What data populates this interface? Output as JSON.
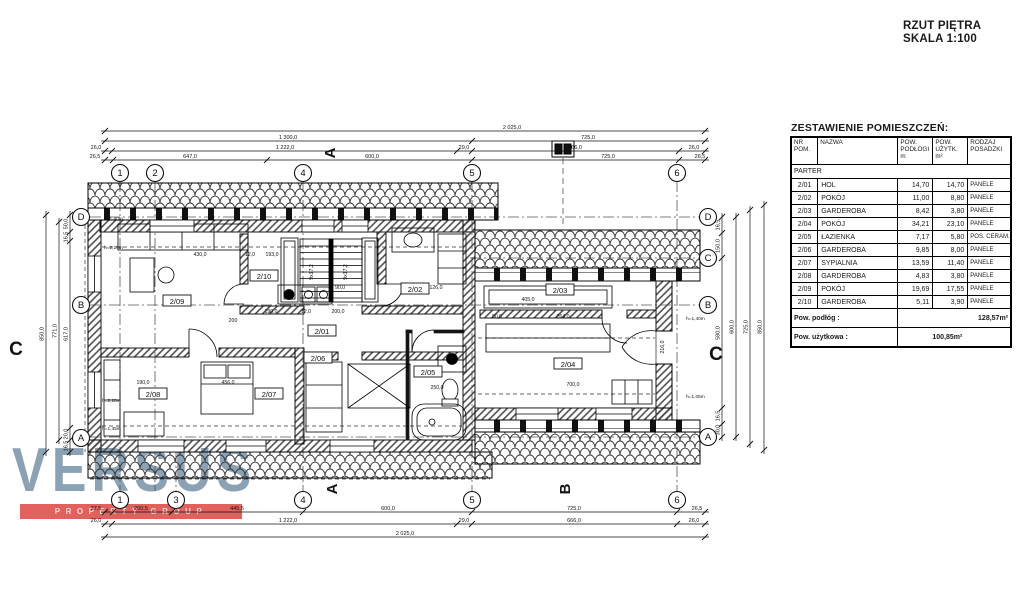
{
  "title": {
    "line1": "RZUT PIĘTRA",
    "line2": "SKALA 1:100"
  },
  "logo": {
    "name": "VERSUS",
    "tagline": "PROPERTY GROUP"
  },
  "colors": {
    "logo_letters": "#8aa2b4",
    "logo_bar": "#e2615d",
    "ink": "#1a1a1a"
  },
  "room_table": {
    "heading": "ZESTAWIENIE POMIESZCZEŃ:",
    "columns": [
      "NR POM.",
      "NAZWA",
      "POW. PODŁOGI m",
      "POW. UŻYTK. m²",
      "RODZAJ POSADZKI"
    ],
    "section": "PARTER",
    "rows": [
      [
        "2/01",
        "HOL",
        "14,70",
        "14,70",
        "PANELE"
      ],
      [
        "2/02",
        "POKÓJ",
        "11,00",
        "8,80",
        "PANELE"
      ],
      [
        "2/03",
        "GARDEROBA",
        "8,42",
        "3,80",
        "PANELE"
      ],
      [
        "2/04",
        "POKÓJ",
        "34,21",
        "23,10",
        "PANELE"
      ],
      [
        "2/05",
        "ŁAZIENKA",
        "7,17",
        "5,80",
        "POS. CERAM."
      ],
      [
        "2/06",
        "GARDEROBA",
        "9,85",
        "8,00",
        "PANELE"
      ],
      [
        "2/07",
        "SYPIALNIA",
        "13,59",
        "11,40",
        "PANELE"
      ],
      [
        "2/08",
        "GARDEROBA",
        "4,83",
        "3,80",
        "PANELE"
      ],
      [
        "2/09",
        "POKÓJ",
        "19,69",
        "17,55",
        "PANELE"
      ],
      [
        "2/10",
        "GARDEROBA",
        "5,11",
        "3,90",
        "PANELE"
      ]
    ],
    "totals": [
      {
        "label": "Pow. podłóg :",
        "value": "128,57m²"
      },
      {
        "label": "Pow. użytkowa :",
        "value": "100,85m²"
      }
    ]
  },
  "plan": {
    "rooms": [
      {
        "id": "2/01",
        "x": 322,
        "y": 333
      },
      {
        "id": "2/02",
        "x": 415,
        "y": 291
      },
      {
        "id": "2/03",
        "x": 560,
        "y": 292
      },
      {
        "id": "2/04",
        "x": 568,
        "y": 366
      },
      {
        "id": "2/05",
        "x": 428,
        "y": 374
      },
      {
        "id": "2/06",
        "x": 318,
        "y": 360
      },
      {
        "id": "2/07",
        "x": 269,
        "y": 396
      },
      {
        "id": "2/08",
        "x": 153,
        "y": 396
      },
      {
        "id": "2/09",
        "x": 177,
        "y": 303
      },
      {
        "id": "2/10",
        "x": 264,
        "y": 278
      }
    ],
    "grid": {
      "top": [
        {
          "l": "1",
          "x": 120
        },
        {
          "l": "2",
          "x": 155
        },
        {
          "l": "4",
          "x": 303
        },
        {
          "l": "5",
          "x": 472
        },
        {
          "l": "6",
          "x": 677
        }
      ],
      "bottom": [
        {
          "l": "1",
          "x": 120
        },
        {
          "l": "3",
          "x": 176
        },
        {
          "l": "4",
          "x": 303
        },
        {
          "l": "5",
          "x": 472
        },
        {
          "l": "6",
          "x": 677
        }
      ],
      "left": [
        {
          "l": "D",
          "y": 217
        },
        {
          "l": "B",
          "y": 305
        },
        {
          "l": "A",
          "y": 438
        }
      ],
      "right": [
        {
          "l": "D",
          "y": 217
        },
        {
          "l": "C",
          "y": 258
        },
        {
          "l": "B",
          "y": 305
        },
        {
          "l": "A",
          "y": 437
        }
      ]
    },
    "sections": [
      {
        "l": "A",
        "x": 335,
        "y": 153,
        "rot": -90,
        "size": 15
      },
      {
        "l": "A",
        "x": 337,
        "y": 489,
        "rot": -90,
        "size": 15
      },
      {
        "l": "B",
        "x": 570,
        "y": 489,
        "rot": -90,
        "size": 15
      },
      {
        "l": "C",
        "x": 16,
        "y": 355,
        "rot": 0,
        "size": 19
      },
      {
        "l": "C",
        "x": 716,
        "y": 360,
        "rot": 0,
        "size": 19
      }
    ],
    "dims": {
      "h": [
        {
          "y": 131,
          "x1": 105,
          "x2": 705,
          "ticks": [
            105,
            705
          ],
          "labels": [
            {
              "t": "2 025,0",
              "x": 512
            }
          ]
        },
        {
          "y": 141,
          "x1": 105,
          "x2": 705,
          "ticks": [
            105,
            472,
            705
          ],
          "labels": [
            {
              "t": "1 300,0",
              "x": 288
            },
            {
              "t": "725,0",
              "x": 588
            }
          ]
        },
        {
          "y": 151,
          "x1": 105,
          "x2": 705,
          "ticks": [
            105,
            112,
            457,
            472,
            679,
            705
          ],
          "labels": [
            {
              "t": "26,0",
              "x": 96
            },
            {
              "t": "1 222,0",
              "x": 285
            },
            {
              "t": "29,0",
              "x": 464
            },
            {
              "t": "666,0",
              "x": 575
            },
            {
              "t": "26,0",
              "x": 694
            }
          ]
        },
        {
          "y": 160,
          "x1": 105,
          "x2": 705,
          "ticks": [
            105,
            113,
            267,
            472,
            679,
            705
          ],
          "labels": [
            {
              "t": "26,5",
              "x": 95
            },
            {
              "t": "647,0",
              "x": 190
            },
            {
              "t": "600,0",
              "x": 372
            },
            {
              "t": "725,0",
              "x": 608
            },
            {
              "t": "26,5",
              "x": 700
            }
          ]
        },
        {
          "y": 512,
          "x1": 105,
          "x2": 705,
          "ticks": [
            105,
            113,
            172,
            303,
            472,
            677,
            705
          ],
          "labels": [
            {
              "t": "27,5",
              "x": 96
            },
            {
              "t": "200,5",
              "x": 141
            },
            {
              "t": "445,5",
              "x": 237
            },
            {
              "t": "600,0",
              "x": 388
            },
            {
              "t": "725,0",
              "x": 574
            },
            {
              "t": "26,5",
              "x": 697
            }
          ]
        },
        {
          "y": 524,
          "x1": 105,
          "x2": 705,
          "ticks": [
            105,
            112,
            457,
            472,
            677,
            705
          ],
          "labels": [
            {
              "t": "26,0",
              "x": 96
            },
            {
              "t": "1 222,0",
              "x": 288
            },
            {
              "t": "29,0",
              "x": 464
            },
            {
              "t": "666,0",
              "x": 574
            },
            {
              "t": "26,0",
              "x": 694
            }
          ]
        },
        {
          "y": 537,
          "x1": 105,
          "x2": 705,
          "ticks": [
            105,
            705
          ],
          "labels": [
            {
              "t": "2 025,0",
              "x": 405
            }
          ]
        }
      ],
      "v": [
        {
          "x": 70,
          "y1": 215,
          "y2": 452,
          "ticks": [
            215,
            232,
            241,
            428,
            440,
            452
          ],
          "labels": [
            {
              "t": "50,0",
              "y": 224
            },
            {
              "t": "16,5",
              "y": 237
            },
            {
              "t": "617,0",
              "y": 334
            },
            {
              "t": "20,0",
              "y": 434
            },
            {
              "t": "16,5",
              "y": 446
            }
          ]
        },
        {
          "x": 59,
          "y1": 222,
          "y2": 440,
          "ticks": [
            222,
            440
          ],
          "labels": [
            {
              "t": "771,0",
              "y": 331
            }
          ]
        },
        {
          "x": 46,
          "y1": 215,
          "y2": 452,
          "ticks": [
            215,
            452
          ],
          "labels": [
            {
              "t": "850,0",
              "y": 334
            }
          ]
        },
        {
          "x": 722,
          "y1": 217,
          "y2": 437,
          "ticks": [
            217,
            233,
            258,
            408,
            424,
            437
          ],
          "labels": [
            {
              "t": "16,5",
              "y": 225
            },
            {
              "t": "150,0",
              "y": 246
            },
            {
              "t": "580,0",
              "y": 333
            },
            {
              "t": "16,5",
              "y": 416
            },
            {
              "t": "30,0",
              "y": 430
            }
          ]
        },
        {
          "x": 736,
          "y1": 217,
          "y2": 437,
          "ticks": [
            217,
            437
          ],
          "labels": [
            {
              "t": "600,0",
              "y": 327
            }
          ]
        },
        {
          "x": 750,
          "y1": 210,
          "y2": 444,
          "ticks": [
            210,
            444
          ],
          "labels": [
            {
              "t": "725,0",
              "y": 327
            }
          ]
        },
        {
          "x": 764,
          "y1": 205,
          "y2": 450,
          "ticks": [
            205,
            450
          ],
          "labels": [
            {
              "t": "850,0",
              "y": 327
            }
          ]
        }
      ],
      "inner": [
        {
          "t": "430,0",
          "x": 200,
          "y": 256
        },
        {
          "t": "12,0",
          "x": 250,
          "y": 256
        },
        {
          "t": "193,0",
          "x": 272,
          "y": 256
        },
        {
          "t": "90,0",
          "x": 340,
          "y": 289
        },
        {
          "t": "126,0",
          "x": 436,
          "y": 289
        },
        {
          "t": "190,0",
          "x": 271,
          "y": 313
        },
        {
          "t": "12,0",
          "x": 306,
          "y": 313
        },
        {
          "t": "200,0",
          "x": 338,
          "y": 313
        },
        {
          "t": "200",
          "x": 233,
          "y": 322
        },
        {
          "t": "405,0",
          "x": 528,
          "y": 301
        },
        {
          "t": "90,0",
          "x": 497,
          "y": 318
        },
        {
          "t": "264,0",
          "x": 563,
          "y": 318
        },
        {
          "t": "190,0",
          "x": 143,
          "y": 384
        },
        {
          "t": "456,0",
          "x": 228,
          "y": 384
        },
        {
          "t": "250,0",
          "x": 437,
          "y": 389
        },
        {
          "t": "700,0",
          "x": 573,
          "y": 386
        },
        {
          "t": "9x17,2",
          "x": 313,
          "y": 272,
          "rot": -90
        },
        {
          "t": "9x17,2",
          "x": 347,
          "y": 272,
          "rot": -90
        },
        {
          "t": "216,0",
          "x": 664,
          "y": 347,
          "rot": -90
        }
      ],
      "notes": [
        {
          "t": "h=1,40m",
          "x": 104,
          "y": 220
        },
        {
          "t": "h=2,20m",
          "x": 104,
          "y": 249
        },
        {
          "t": "h=2,20m",
          "x": 102,
          "y": 402
        },
        {
          "t": "h=1,45m",
          "x": 102,
          "y": 430
        },
        {
          "t": "h=1,40m",
          "x": 686,
          "y": 320
        },
        {
          "t": "h=1,05m",
          "x": 686,
          "y": 398
        }
      ]
    }
  }
}
